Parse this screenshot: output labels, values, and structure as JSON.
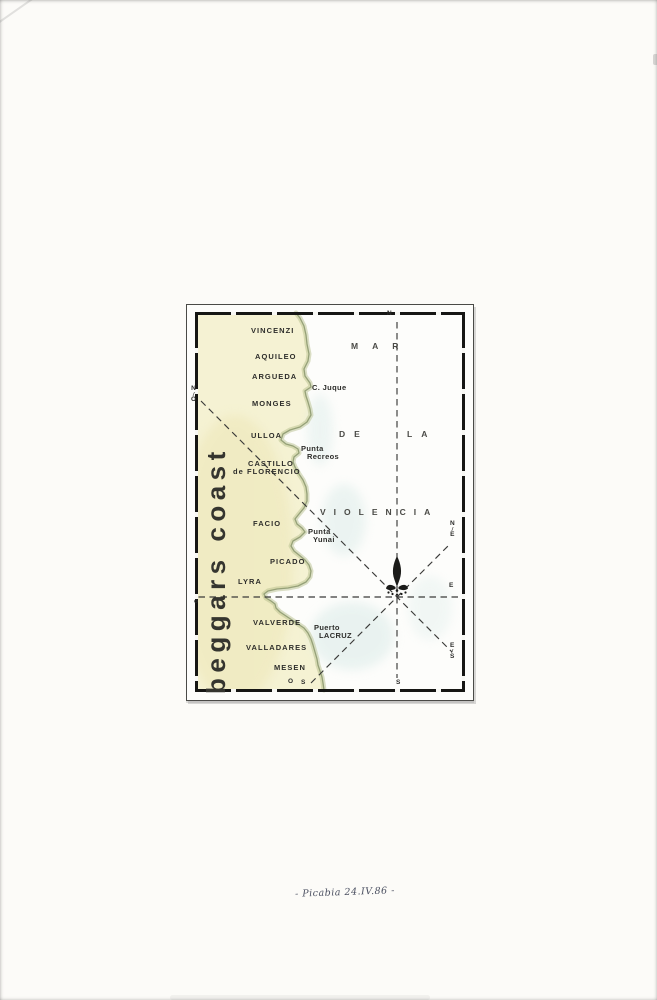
{
  "page": {
    "signature": "- Picabia 24.IV.86 -"
  },
  "map": {
    "title": "beggars coast",
    "sea_name": [
      {
        "text": "MAR",
        "x": 351,
        "y": 341,
        "ls": 14
      },
      {
        "text": "DE",
        "x": 339,
        "y": 429,
        "ls": 9
      },
      {
        "text": "LA",
        "x": 407,
        "y": 429,
        "ls": 9
      },
      {
        "text": "VIOLENCIA",
        "x": 320,
        "y": 507,
        "ls": 8
      }
    ],
    "places": [
      {
        "text": "VINCENZI",
        "x": 251,
        "y": 327
      },
      {
        "text": "AQUILEO",
        "x": 255,
        "y": 353
      },
      {
        "text": "ARGUEDA",
        "x": 252,
        "y": 373
      },
      {
        "text": "C. Juque",
        "x": 312,
        "y": 384,
        "style": "mixed"
      },
      {
        "text": "MONGES",
        "x": 252,
        "y": 400
      },
      {
        "text": "ULLOA",
        "x": 251,
        "y": 432
      },
      {
        "text": "Punta",
        "line2": "Recreos",
        "line2_dx": 6,
        "x": 301,
        "y": 445,
        "style": "mixed"
      },
      {
        "text": "CASTILLO",
        "line2": "de FLORENCIO",
        "line2_dx": -15,
        "x": 248,
        "y": 460
      },
      {
        "text": "FACIO",
        "x": 253,
        "y": 520
      },
      {
        "text": "Punta",
        "line2": "Yunai",
        "line2_dx": 5,
        "x": 308,
        "y": 528,
        "style": "mixed"
      },
      {
        "text": "PICADO",
        "x": 270,
        "y": 558
      },
      {
        "text": "LYRA",
        "x": 238,
        "y": 578
      },
      {
        "text": "VALVERDE",
        "x": 253,
        "y": 619
      },
      {
        "text": "Puerto",
        "line2": "LACRUZ",
        "line2_dx": 5,
        "x": 314,
        "y": 624,
        "style": "mixed"
      },
      {
        "text": "VALLADARES",
        "x": 246,
        "y": 644
      },
      {
        "text": "MESEN",
        "x": 274,
        "y": 664
      }
    ],
    "compass": [
      {
        "text": "N",
        "x": 387,
        "y": 311
      },
      {
        "text": "S",
        "x": 396,
        "y": 680
      },
      {
        "text": "o",
        "x": 194,
        "y": 599
      },
      {
        "text": "E",
        "x": 449,
        "y": 583
      },
      {
        "text": "N/E",
        "x": 450,
        "y": 521,
        "stack": true
      },
      {
        "text": "E/S",
        "x": 450,
        "y": 643,
        "stack": true
      },
      {
        "text": "N/O",
        "x": 191,
        "y": 386,
        "stack": true
      },
      {
        "text": "O",
        "x": 288,
        "y": 679
      },
      {
        "text": "S",
        "x": 301,
        "y": 680
      }
    ],
    "colors": {
      "land": "#f5f2d3",
      "land_deep": "#ece5b4",
      "coast_edge": "#b7c08d",
      "coast_line": "#8e9a70",
      "sea_tint": "#d7e9e6",
      "ink": "#2e2e2b",
      "border": "#1b1b19"
    }
  }
}
